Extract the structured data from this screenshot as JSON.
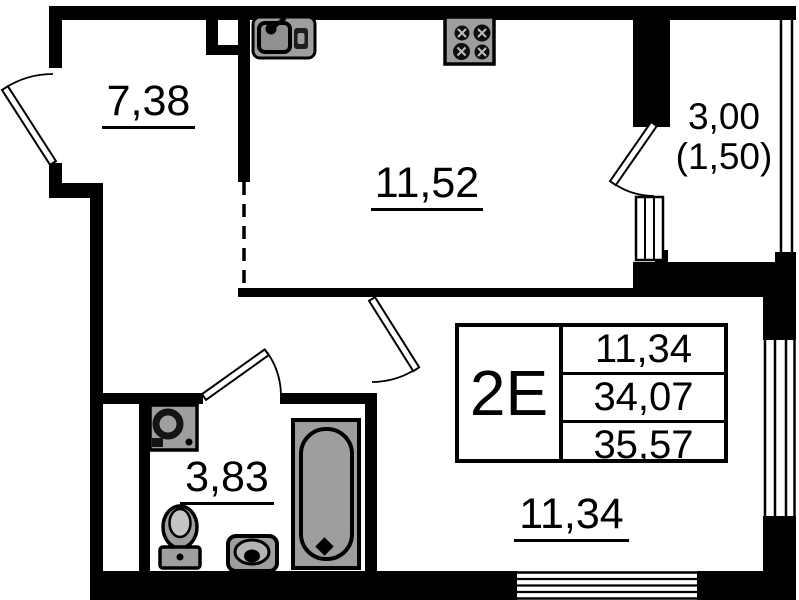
{
  "plan": {
    "unit_type_label": "2E",
    "spec_rows": [
      "11,34",
      "34,07",
      "35,57"
    ],
    "rooms": {
      "hallway_area": "7,38",
      "kitchen_area": "11,52",
      "bathroom_area": "3,83",
      "living_room_area": "11,34",
      "balcony_area_total": "3,00",
      "balcony_area_reduced": "(1,50)"
    },
    "colors": {
      "wall": "#000000",
      "fixture_fill": "#9e9e9e",
      "line": "#000000",
      "background": "#ffffff"
    }
  }
}
